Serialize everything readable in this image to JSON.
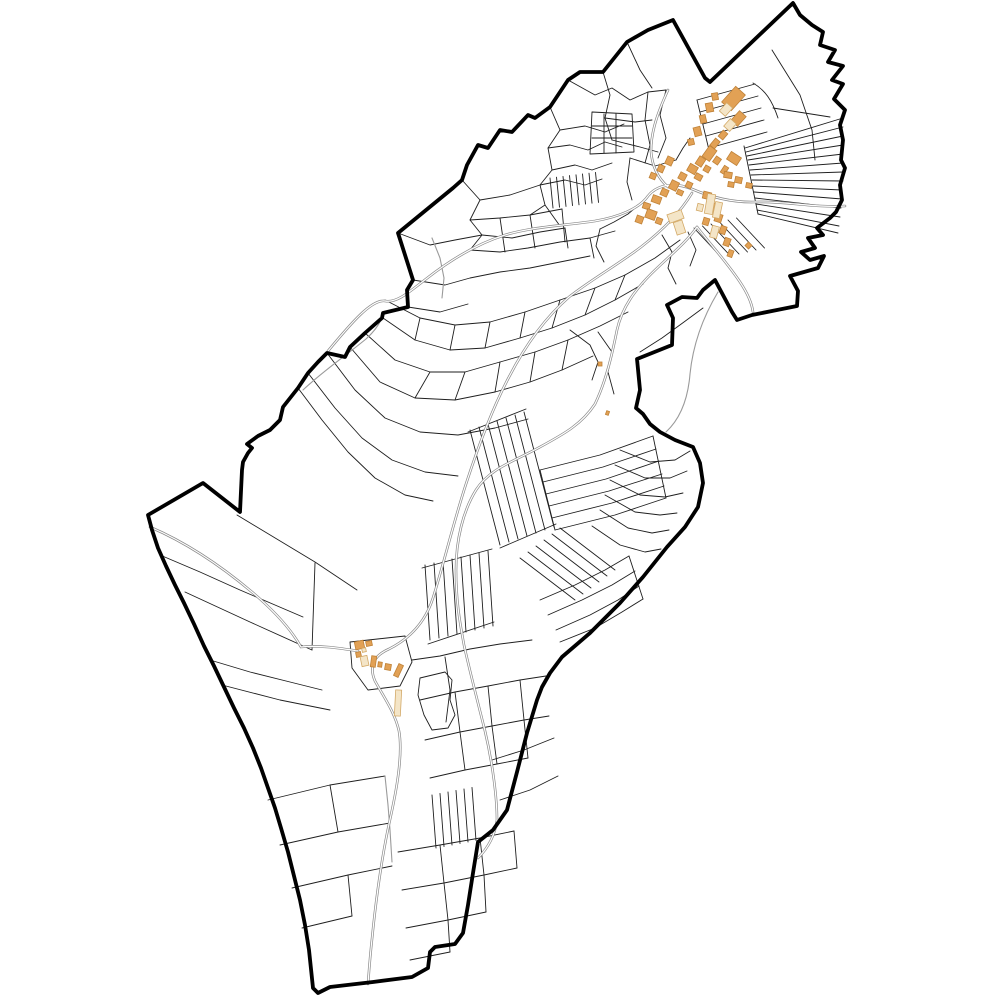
{
  "map": {
    "title": "cadastral-commune-map",
    "colors": {
      "background": "#ffffff",
      "boundary": "#000000",
      "parcel_line": "#1e1e1e",
      "road_casing": "#8a8a8a",
      "road_core": "#ffffff",
      "track_line": "#9a9a9a",
      "building_fill": "#e2a155",
      "building_stroke": "#bf8238",
      "building_pale_fill": "#f4e5c7",
      "building_pale_stroke": "#d3a967"
    },
    "boundary_path": "M793,3 L800,15 812,25 823,32 820,45 835,50 828,62 843,66 832,80 843,84 834,99 845,110 840,125 843,140 841,160 845,168 840,185 842,200 836,212 830,218 817,228 823,235 808,238 815,248 801,252 810,260 824,256 818,268 804,272 790,276 798,291 797,306 777,310 752,315 737,320 732,312 715,280 703,290 697,298 682,297 667,305 673,318 672,345 637,359 640,390 636,408 643,414 650,424 660,432 675,440 693,447 700,463 703,483 698,507 685,527 667,547 643,577 620,603 590,633 562,657 550,673 542,687 537,700 527,733 517,772 507,810 493,830 478,842 473,873 468,905 463,933 455,944 435,947 430,952 428,968 412,977 373,982 330,987 318,993 313,988 309,950 305,925 300,900 294,876 288,852 281,828 275,808 268,788 261,768 253,748 244,728 234,708 224,687 214,666 204,646 194,624 184,603 175,585 166,566 158,548 152,530 148,515 203,483 240,512 242,470 243,462 248,453 252,448 247,444 258,436 270,430 280,420 283,407 298,388 308,373 318,362 327,353 345,357 350,347 365,333 382,318 383,313 408,307 407,290 413,280 398,233 453,188 462,180 467,165 478,145 488,148 500,130 512,132 528,115 535,118 550,107 568,80 580,72 603,72 627,42 648,30 673,20 705,78 710,82 Z",
    "parcel_paths": [
      "M550,107 L560,130 548,148 552,170 540,185 545,205 530,215",
      "M462,180 L480,200 470,220 482,235 470,250",
      "M480,200 L510,195 540,185",
      "M470,220 L500,218 530,215 562,209",
      "M482,235 L512,238 540,232 565,228",
      "M540,185 L565,180 585,185 602,179",
      "M552,170 L575,165 592,170 612,163",
      "M548,148 L570,145 588,150 605,142 622,147",
      "M560,130 L585,126 605,132 624,124",
      "M592,112 L632,114 634,152 590,154 Z",
      "M592,126 L632,126 M592,138 L632,138 M604,114 L604,153 M616,114 L616,153",
      "M398,233 L430,245 455,240 482,235",
      "M413,280 L445,285 470,278 500,272 530,268 560,262 590,256",
      "M470,250 L500,252 528,248 560,242 590,238 615,231",
      "M408,307 L440,312 468,304",
      "M500,218 L505,252 M530,215 L535,248 M562,209 L565,242 M590,238 L594,258",
      "M565,228 L568,248 M545,205 L560,226",
      "M568,80 L595,95 612,88 630,100 648,92 666,90",
      "M627,42 L640,70 652,88",
      "M666,90 L660,115 666,138 658,158",
      "M648,92 L645,120 650,145 645,163",
      "M603,72 L610,95 605,118 612,140",
      "M612,140 L640,147 658,152",
      "M605,118 L635,122 652,120",
      "M773,108 L830,117",
      "M753,83 C765,90 772,100 778,118",
      "M697,100 L709,150",
      "M744,146 L758,214",
      "M758,214 L838,233",
      "M772,50 L800,95 812,130 815,160",
      "M745,148 L843,118",
      "M746,152 L843,127",
      "M747,156 L843,136",
      "M748,160 L843,145",
      "M749,165 L843,154",
      "M750,170 L843,163",
      "M751,175 L843,172",
      "M752,180 L843,181",
      "M753,186 L842,190",
      "M754,192 L842,199",
      "M755,198 L841,208",
      "M756,204 L840,217",
      "M757,210 L839,226",
      "M630,158 L655,166 676,160",
      "M640,204 L628,214 614,222 600,229",
      "M630,158 L627,182 632,200",
      "M676,160 L683,148 690,138",
      "M600,229 L596,246 604,262",
      "M662,235 L672,252 668,268 676,284",
      "M688,232 L696,250 690,266",
      "M385,300 L420,318 455,325 490,322 525,312 560,300 595,288 625,275 655,258 680,240",
      "M383,318 L415,340 450,350 485,348 520,338 552,328 585,315 615,300 643,284",
      "M365,333 L395,360 430,372 465,372 500,362 535,352 568,340 600,326 628,312",
      "M350,347 L380,382 415,398 455,400 495,392 530,382 562,370 593,356",
      "M327,353 L355,390 385,418 420,432 458,435 495,428 528,419",
      "M308,373 L335,408 362,438 392,460 425,472 458,476",
      "M298,388 L322,420 348,452 375,478 405,495 433,501",
      "M420,318 L415,340 M455,325 L450,350 M490,322 L485,348 M525,312 L520,338 M560,300 L552,328 M595,288 L585,315 M625,275 L615,300",
      "M430,372 L415,398 M465,372 L455,400 M500,362 L495,392 M535,352 L530,382 M568,340 L562,370",
      "M598,332 L612,352 608,372 614,394",
      "M570,330 L590,345 598,362 592,380",
      "M620,450 L650,462 675,460 690,451",
      "M615,465 L645,478 670,478 687,471",
      "M610,480 L640,495 665,497 683,493",
      "M605,495 L635,512 660,515 677,513",
      "M600,510 L628,528 652,533 669,530",
      "M592,526 L620,545 645,552 661,549",
      "M540,470 L600,455 653,436",
      "M543,482 L603,467 656,449",
      "M546,494 L606,479 659,461",
      "M549,506 L609,491 662,474",
      "M552,518 L612,503 664,486",
      "M555,530 L615,515 666,498",
      "M540,470 L555,530 M653,436 L666,498",
      "M540,600 L575,585 605,570 629,556",
      "M548,615 L582,600 612,585 635,571",
      "M556,630 L590,615 618,600 639,586",
      "M560,642 L595,628 622,612 643,599",
      "M629,556 L643,599",
      "M468,432 L526,409",
      "M500,548 L556,524",
      "M422,568 L492,549",
      "M428,644 L494,622",
      "M350,642 L405,636 412,662 400,686 368,690 352,668 Z",
      "M412,660 L440,656 470,649 500,644 532,640",
      "M445,657 L450,690 446,722",
      "M420,700 L455,692 488,686 520,680 546,676",
      "M425,740 L460,732 492,726 524,720 549,716",
      "M430,778 L465,770 497,764 528,758",
      "M455,692 L460,732 M488,686 L492,726 M520,680 L524,720 M460,732 L465,770 M492,726 L497,764 M524,720 L528,758",
      "M420,678 L445,672 452,680 450,700 455,715 448,728 432,730 424,715 418,695 Z",
      "M398,852 L440,845 480,838 514,831",
      "M402,890 L444,883 484,875 517,868",
      "M406,928 L448,920 486,912",
      "M410,960 L450,952",
      "M440,845 L444,883 M480,838 L484,875 M514,831 L517,868 M444,883 L448,920 M484,875 L486,912 M448,920 L450,952",
      "M237,515 L315,562 357,590",
      "M315,563 L312,650",
      "M185,592 L250,622 312,650",
      "M160,555 L200,572 240,590 275,605 303,617",
      "M210,660 L250,672 290,682 322,690",
      "M222,685 L280,700 330,710",
      "M268,800 L330,785 385,776",
      "M280,845 L338,832 390,823",
      "M330,785 L338,832",
      "M292,888 L348,875 392,866",
      "M302,928 L352,916",
      "M348,875 L352,916",
      "M640,352 L662,338 684,322 703,308",
      "M500,800 L530,790 558,776",
      "M492,760 L524,750 554,738"
    ],
    "parcel_fans": [
      {
        "x1": 697,
        "y1": 100,
        "x2": 755,
        "y2": 84,
        "dx": 3,
        "dy": 12,
        "n": 5
      },
      {
        "x1": 694,
        "y1": 228,
        "x2": 722,
        "y2": 258,
        "dx": 8.5,
        "dy": -2,
        "n": 6
      },
      {
        "x1": 550,
        "y1": 178,
        "x2": 553,
        "y2": 208,
        "dx": 6.5,
        "dy": -0.8,
        "n": 8
      },
      {
        "x1": 470,
        "y1": 430,
        "x2": 500,
        "y2": 545,
        "dx": 9,
        "dy": -3,
        "n": 7
      },
      {
        "x1": 425,
        "y1": 565,
        "x2": 430,
        "y2": 640,
        "dx": 9,
        "dy": -2,
        "n": 8
      },
      {
        "x1": 520,
        "y1": 558,
        "x2": 575,
        "y2": 600,
        "dx": 8,
        "dy": -6,
        "n": 6
      },
      {
        "x1": 432,
        "y1": 795,
        "x2": 436,
        "y2": 848,
        "dx": 8,
        "dy": -1.5,
        "n": 6
      }
    ],
    "track_paths": [
      "M718,292 C703,317 693,344 690,374 C688,399 680,419 666,432",
      "M303,390 C322,372 344,357 366,339 C377,329 381,321 383,315",
      "M385,776 L388,805 390,830 392,862",
      "M432,238 L440,258 444,278 442,298"
    ],
    "road_paths": [
      "M845,206 C815,208 785,201 756,202 C728,203 706,195 692,189 C672,181 656,186 648,196 C639,209 618,217 595,221 C560,226 532,227 505,235 C476,244 449,261 426,279 C407,294 396,303 385,301 C372,299 352,322 328,351",
      "M692,193 C680,213 663,230 641,247 C616,266 592,279 569,297 C546,317 526,344 509,377 C493,407 479,444 466,484 C453,524 444,563 433,598 C425,623 409,639 389,649 C373,656 369,667 375,681 C385,699 395,713 399,731 C403,754 397,789 389,824 C382,857 376,899 372,939 C370,957 369,971 368,984",
      "M150,527 C185,542 220,565 252,592 C278,614 292,631 301,647 C319,645 339,648 358,651",
      "M697,227 C685,244 668,257 651,274 C636,289 622,307 617,330 C612,355 606,381 595,404 C582,424 564,434 540,447 C515,461 490,468 476,490 C463,511 456,540 456,570 C456,602 460,623 464,645 C469,668 477,699 485,731 C493,765 497,799 497,820 C495,835 488,848 478,858",
      "M697,227 C710,244 726,261 740,282 C748,294 752,304 753,312",
      "M668,90 C658,112 651,131 651,151 C652,167 659,179 668,187"
    ],
    "buildings": [
      {
        "x": 727,
        "y": 88,
        "w": 13,
        "h": 21,
        "r": 42,
        "p": 0
      },
      {
        "x": 734,
        "y": 112,
        "w": 9,
        "h": 13,
        "r": 42,
        "p": 0
      },
      {
        "x": 722,
        "y": 104,
        "w": 8,
        "h": 11,
        "r": 42,
        "p": 1
      },
      {
        "x": 726,
        "y": 120,
        "w": 8,
        "h": 10,
        "r": 42,
        "p": 1
      },
      {
        "x": 728,
        "y": 154,
        "w": 12,
        "h": 9,
        "r": 33,
        "p": 0
      },
      {
        "x": 722,
        "y": 166,
        "w": 5,
        "h": 8,
        "r": 33,
        "p": 0
      },
      {
        "x": 712,
        "y": 139,
        "w": 6,
        "h": 9,
        "r": 40,
        "p": 0
      },
      {
        "x": 720,
        "y": 131,
        "w": 6,
        "h": 8,
        "r": 40,
        "p": 0
      },
      {
        "x": 705,
        "y": 147,
        "w": 9,
        "h": 13,
        "r": 36,
        "p": 0
      },
      {
        "x": 697,
        "y": 157,
        "w": 7,
        "h": 9,
        "r": 33,
        "p": 0
      },
      {
        "x": 688,
        "y": 165,
        "w": 9,
        "h": 8,
        "r": 30,
        "p": 0
      },
      {
        "x": 679,
        "y": 173,
        "w": 7,
        "h": 7,
        "r": 28,
        "p": 0
      },
      {
        "x": 670,
        "y": 181,
        "w": 8,
        "h": 9,
        "r": 26,
        "p": 0
      },
      {
        "x": 661,
        "y": 189,
        "w": 7,
        "h": 7,
        "r": 24,
        "p": 0
      },
      {
        "x": 652,
        "y": 196,
        "w": 9,
        "h": 7,
        "r": 20,
        "p": 0
      },
      {
        "x": 643,
        "y": 203,
        "w": 7,
        "h": 6,
        "r": 18,
        "p": 0
      },
      {
        "x": 714,
        "y": 157,
        "w": 6,
        "h": 7,
        "r": 35,
        "p": 0
      },
      {
        "x": 704,
        "y": 166,
        "w": 6,
        "h": 6,
        "r": 30,
        "p": 0
      },
      {
        "x": 695,
        "y": 174,
        "w": 7,
        "h": 6,
        "r": 28,
        "p": 0
      },
      {
        "x": 686,
        "y": 182,
        "w": 6,
        "h": 6,
        "r": 26,
        "p": 0
      },
      {
        "x": 677,
        "y": 190,
        "w": 6,
        "h": 5,
        "r": 24,
        "p": 0
      },
      {
        "x": 694,
        "y": 127,
        "w": 7,
        "h": 9,
        "r": -14,
        "p": 0
      },
      {
        "x": 700,
        "y": 115,
        "w": 6,
        "h": 8,
        "r": -13,
        "p": 0
      },
      {
        "x": 706,
        "y": 103,
        "w": 7,
        "h": 9,
        "r": -11,
        "p": 0
      },
      {
        "x": 712,
        "y": 93,
        "w": 6,
        "h": 7,
        "r": -10,
        "p": 0
      },
      {
        "x": 688,
        "y": 139,
        "w": 6,
        "h": 6,
        "r": -14,
        "p": 0
      },
      {
        "x": 724,
        "y": 172,
        "w": 8,
        "h": 6,
        "r": 10,
        "p": 0
      },
      {
        "x": 735,
        "y": 177,
        "w": 7,
        "h": 6,
        "r": 12,
        "p": 0
      },
      {
        "x": 746,
        "y": 183,
        "w": 6,
        "h": 5,
        "r": 12,
        "p": 0
      },
      {
        "x": 728,
        "y": 182,
        "w": 6,
        "h": 5,
        "r": 10,
        "p": 0
      },
      {
        "x": 703,
        "y": 192,
        "w": 8,
        "h": 7,
        "r": 14,
        "p": 0
      },
      {
        "x": 710,
        "y": 203,
        "w": 7,
        "h": 8,
        "r": 17,
        "p": 0
      },
      {
        "x": 715,
        "y": 214,
        "w": 7,
        "h": 8,
        "r": 18,
        "p": 0
      },
      {
        "x": 720,
        "y": 226,
        "w": 6,
        "h": 8,
        "r": 19,
        "p": 0
      },
      {
        "x": 724,
        "y": 238,
        "w": 6,
        "h": 8,
        "r": 20,
        "p": 0
      },
      {
        "x": 728,
        "y": 250,
        "w": 5,
        "h": 7,
        "r": 20,
        "p": 0
      },
      {
        "x": 703,
        "y": 218,
        "w": 6,
        "h": 7,
        "r": 17,
        "p": 0
      },
      {
        "x": 646,
        "y": 210,
        "w": 10,
        "h": 9,
        "r": 20,
        "p": 0
      },
      {
        "x": 636,
        "y": 216,
        "w": 7,
        "h": 7,
        "r": 20,
        "p": 0
      },
      {
        "x": 656,
        "y": 218,
        "w": 6,
        "h": 6,
        "r": 20,
        "p": 0
      },
      {
        "x": 666,
        "y": 157,
        "w": 7,
        "h": 8,
        "r": 25,
        "p": 0
      },
      {
        "x": 658,
        "y": 165,
        "w": 6,
        "h": 7,
        "r": 24,
        "p": 0
      },
      {
        "x": 650,
        "y": 173,
        "w": 6,
        "h": 6,
        "r": 22,
        "p": 0
      },
      {
        "x": 668,
        "y": 212,
        "w": 15,
        "h": 9,
        "r": -20,
        "p": 1
      },
      {
        "x": 675,
        "y": 221,
        "w": 9,
        "h": 13,
        "r": -18,
        "p": 1
      },
      {
        "x": 706,
        "y": 194,
        "w": 8,
        "h": 20,
        "r": 10,
        "p": 1
      },
      {
        "x": 714,
        "y": 202,
        "w": 7,
        "h": 16,
        "r": 12,
        "p": 1
      },
      {
        "x": 711,
        "y": 226,
        "w": 7,
        "h": 12,
        "r": 15,
        "p": 1
      },
      {
        "x": 697,
        "y": 204,
        "w": 6,
        "h": 7,
        "r": 14,
        "p": 1
      },
      {
        "x": 598,
        "y": 362,
        "w": 4,
        "h": 4,
        "r": 0,
        "p": 0
      },
      {
        "x": 606,
        "y": 411,
        "w": 3,
        "h": 4,
        "r": 20,
        "p": 0
      },
      {
        "x": 746,
        "y": 243,
        "w": 5,
        "h": 5,
        "r": 45,
        "p": 0
      },
      {
        "x": 355,
        "y": 641,
        "w": 9,
        "h": 8,
        "r": -12,
        "p": 0
      },
      {
        "x": 366,
        "y": 641,
        "w": 6,
        "h": 5,
        "r": -12,
        "p": 0
      },
      {
        "x": 356,
        "y": 652,
        "w": 5,
        "h": 5,
        "r": -12,
        "p": 0
      },
      {
        "x": 362,
        "y": 648,
        "w": 4,
        "h": 4,
        "r": -12,
        "p": 1
      },
      {
        "x": 361,
        "y": 656,
        "w": 7,
        "h": 10,
        "r": -12,
        "p": 1
      },
      {
        "x": 371,
        "y": 656,
        "w": 5,
        "h": 11,
        "r": 8,
        "p": 0
      },
      {
        "x": 378,
        "y": 662,
        "w": 4,
        "h": 5,
        "r": 8,
        "p": 0
      },
      {
        "x": 385,
        "y": 664,
        "w": 6,
        "h": 6,
        "r": 10,
        "p": 0
      },
      {
        "x": 396,
        "y": 664,
        "w": 5,
        "h": 13,
        "r": 25,
        "p": 0
      },
      {
        "x": 395,
        "y": 690,
        "w": 6,
        "h": 26,
        "r": 3,
        "p": 1
      }
    ]
  }
}
